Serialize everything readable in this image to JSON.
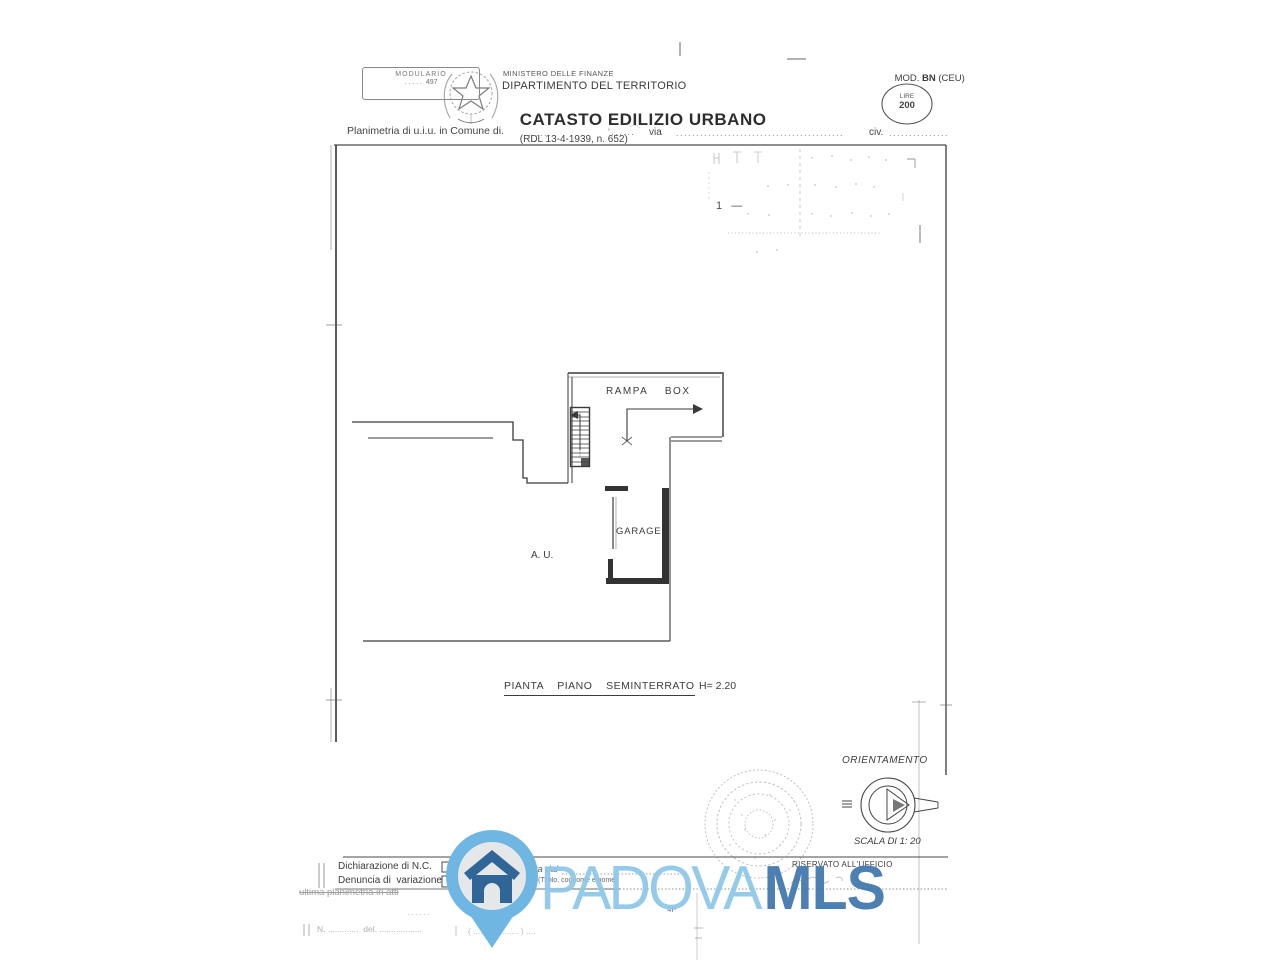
{
  "header": {
    "form_box": {
      "line1": "MODULARIO",
      "line2": ". . . . .  497"
    },
    "ministry_small": "MINISTERO DELLE FINANZE",
    "department": "DIPARTIMENTO DEL TERRITORIO",
    "title": "CATASTO EDILIZIO URBANO",
    "title_ref": "(RDL 13-4-1939, n. 652)",
    "mod_prefix": "MOD. ",
    "mod_code": "BN",
    "mod_suffix": " (CEU)",
    "fee_stamp": {
      "line1": "LIRE",
      "line2": "200"
    }
  },
  "address_row": {
    "label": "Planimetria di u.i.u. in Comune di.",
    "dots_a": "......",
    "dots_b": "'......",
    "via_label": "via",
    "dots_c": "..........................................",
    "civ_label": "civ.",
    "dots_d": "..............."
  },
  "plan": {
    "pencil_note": "1   —",
    "rampa_label": "RAMPA    BOX",
    "garage_label": "GARAGE",
    "au_label": "A. U.",
    "caption": "PIANTA    PIANO    SEMINTERRATO",
    "height_note": "H= 2.20"
  },
  "orientation": {
    "title": "ORIENTAMENTO",
    "scale": "SCALA DI 1: 20"
  },
  "footer": {
    "declaration_label": "Dichiarazione di N.C.",
    "variation_label": "Denuncia di  variazione",
    "struck_note": "ultima planimetria in atti",
    "compiled_label": "Compilata dal",
    "name_hint": "(Titolo, cognome e nome)",
    "reserved_label": "RISERVATO ALL'UFFICIO",
    "sheet_mark": "4P",
    "mini_dots": "......",
    "faint_row_left": "N. .............  del. ..................",
    "faint_row_right": "( ....  ( ........... ) ...."
  },
  "watermark": {
    "brand_light": "PADOVA",
    "brand_bold": "MLS"
  },
  "colors": {
    "ink": "#3c3c3c",
    "wm_light_blue": "#8dc8e9",
    "wm_dark_blue": "#4077ad",
    "pin_ring": "#6fb7e2",
    "pin_inner": "#e5e7e9",
    "pin_house": "#2f6597"
  }
}
